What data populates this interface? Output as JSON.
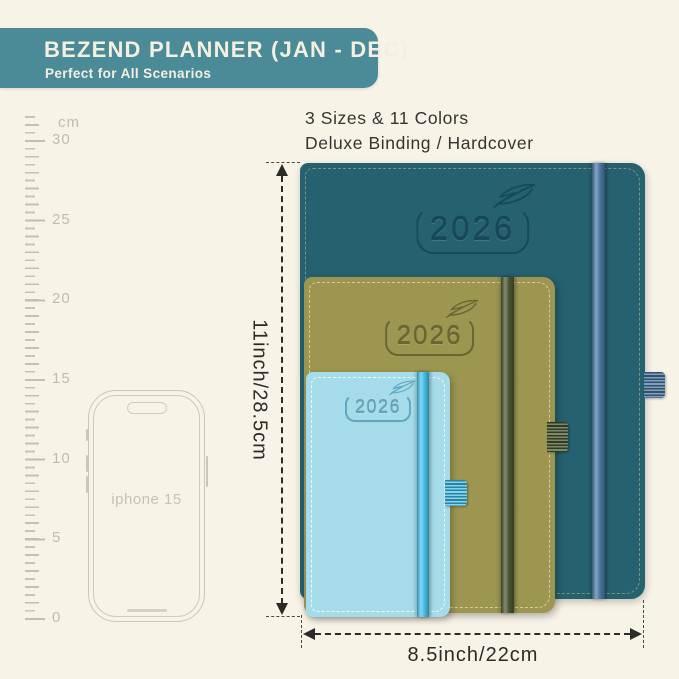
{
  "header": {
    "title": "BEZEND PLANNER (JAN - DEC)",
    "subtitle": "Perfect for All Scenarios",
    "bg_color": "#4a8b97",
    "text_color": "#f4efe1"
  },
  "product_info": {
    "sizes_line": "3 Sizes & 11 Colors",
    "binding_line": "Deluxe Binding / Hardcover"
  },
  "ruler": {
    "unit_label": "cm",
    "tick_labels": [
      "30",
      "25",
      "20",
      "15",
      "10",
      "5",
      "0"
    ]
  },
  "phone": {
    "label": "iphone 15"
  },
  "planners": [
    {
      "name": "large-teal",
      "year": "2026",
      "cover_color": "#26616f",
      "band_color": "#4e7ca6"
    },
    {
      "name": "medium-olive",
      "year": "2026",
      "cover_color": "#9c9650",
      "band_color": "#4d5a34"
    },
    {
      "name": "small-blue",
      "year": "2026",
      "cover_color": "#a6dbe9",
      "band_color": "#49c6ee"
    }
  ],
  "dimensions": {
    "height_label": "11inch/28.5cm",
    "width_label": "8.5inch/22cm"
  },
  "colors": {
    "background": "#f7f3e7",
    "annotation": "#2b2b27",
    "ruler_gray": "#c7c3b5"
  }
}
